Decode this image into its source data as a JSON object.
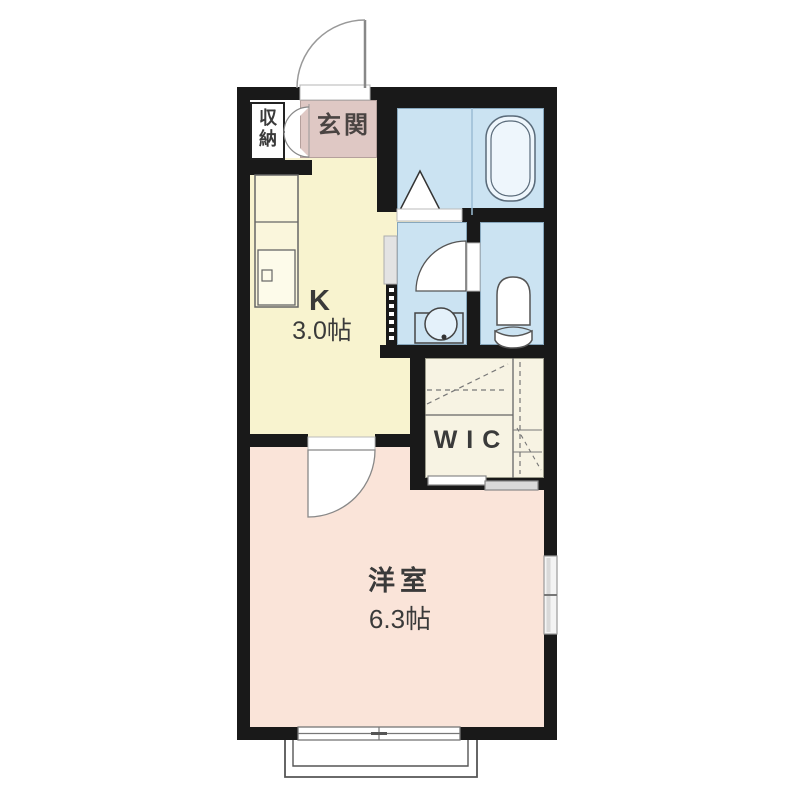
{
  "floorplan": {
    "title": "1K apartment floor plan",
    "rooms": {
      "entrance": {
        "label": "玄関"
      },
      "storage": {
        "label": "収納"
      },
      "kitchen": {
        "label": "K",
        "size": "3.0帖"
      },
      "wic": {
        "label": "WIC"
      },
      "western_room": {
        "label": "洋室",
        "size": "6.3帖"
      }
    },
    "colors": {
      "wall": "#191919",
      "kitchen": "#f8f3cf",
      "western_room": "#fae4d9",
      "wet_area": "#cbe3f2",
      "entrance": "#dfc8c4",
      "wic": "#f7f3e3",
      "background": "#ffffff"
    }
  }
}
